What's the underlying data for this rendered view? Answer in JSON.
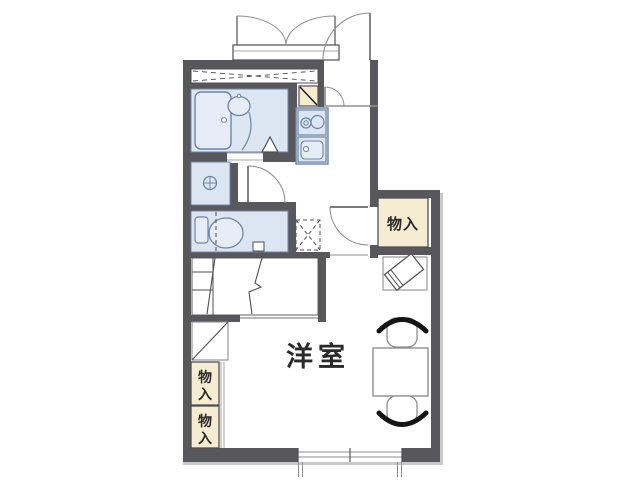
{
  "page": {
    "background": "#ffffff"
  },
  "colors": {
    "wall": "#58585c",
    "fill_blue": "#dce6f3",
    "fill_blue_light": "#e7edf7",
    "stroke_blue": "#6f84a4",
    "fill_tan": "#f6ecd2",
    "line": "#4f4f54",
    "line_light": "#8e8e93",
    "black": "#141414",
    "text": "#2a2a2a",
    "shadow": "#c9c9cc",
    "white": "#ffffff"
  },
  "labels": {
    "room": "洋室",
    "storage_right": "物入",
    "storage_bottom_upper_char1": "物",
    "storage_bottom_upper_char2": "入",
    "storage_bottom_lower_char1": "物",
    "storage_bottom_lower_char2": "入"
  }
}
